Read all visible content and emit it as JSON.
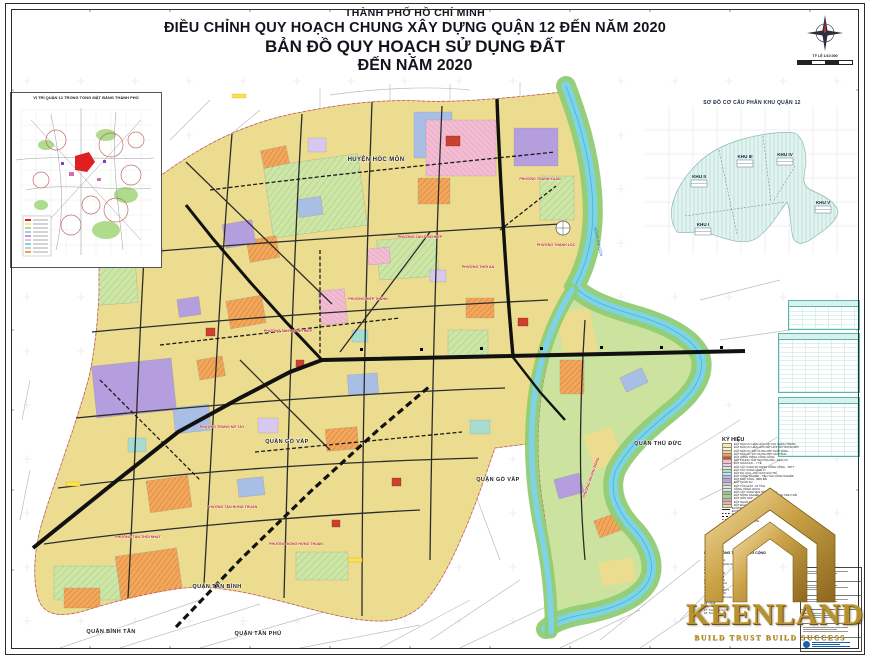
{
  "sheet": {
    "title_line1": "THÀNH PHỐ HỒ CHÍ MINH",
    "title_line2": "ĐIỀU CHỈNH QUY HOẠCH CHUNG XÂY DỰNG QUẬN 12 ĐẾN NĂM 2020",
    "title_line3": "BẢN ĐỒ QUY HOẠCH SỬ DỤNG ĐẤT",
    "title_line4": "ĐẾN NĂM 2020",
    "scale_label": "TỶ LỆ 1/10.000"
  },
  "inset_left": {
    "title": "VỊ TRÍ QUẬN 12 TRONG TỔNG MẶT BẰNG THÀNH PHỐ"
  },
  "inset_right": {
    "title": "SƠ ĐỒ CƠ CẤU PHÂN KHU QUẬN 12",
    "zones": [
      "KHU I",
      "KHU II",
      "KHU III",
      "KHU IV",
      "KHU V"
    ]
  },
  "neighbors": {
    "hoc_mon": "HUYỆN HÓC MÔN",
    "go_vap_a": "QUẬN GÒ VẤP",
    "go_vap_b": "QUẬN GÒ VẤP",
    "thu_duc": "QUẬN THỦ ĐỨC",
    "tan_binh": "QUẬN TÂN BÌNH",
    "binh_tan": "QUẬN BÌNH TÂN",
    "tan_phu": "QUẬN TÂN PHÚ"
  },
  "river_label": "SÔNG SÀI GÒN",
  "wards": [
    "PHƯỜNG THẠNH XUÂN",
    "PHƯỜNG THẠNH LỘC",
    "PHƯỜNG AN PHÚ ĐÔNG",
    "PHƯỜNG THỚI AN",
    "PHƯỜNG TÂN THỚI HIỆP",
    "PHƯỜNG HIỆP THÀNH",
    "PHƯỜNG TÂN CHÁNH HIỆP",
    "PHƯỜNG TRUNG MỸ TÂY",
    "PHƯỜNG TÂN THỚI NHẤT",
    "PHƯỜNG ĐÔNG HƯNG THUẬN",
    "PHƯỜNG TÂN HƯNG THUẬN"
  ],
  "legend": {
    "title": "KÝ HIỆU",
    "items": [
      {
        "type": "fill",
        "color": "#F6E89C",
        "label": "ĐẤT DÂN CƯ HIỆN HỮU CẢI TẠO CHỈNH TRANG"
      },
      {
        "type": "fill",
        "color": "#FBF3CE",
        "label": "ĐẤT DÂN CƯ HIỆN HỮU KẾT HỢP XÂY DỰNG MỚI"
      },
      {
        "type": "fill",
        "color": "#F4CE92",
        "label": "ĐẤT DÂN CƯ XÂY DỰNG MỚI THẤP TẦNG"
      },
      {
        "type": "fill",
        "color": "#EFA050",
        "label": "ĐẤT DÂN CƯ XÂY DỰNG MỚI CAO TẦNG"
      },
      {
        "type": "fill",
        "color": "#D84B2E",
        "label": "ĐẤT CÔNG TRÌNH CÔNG CỘNG"
      },
      {
        "type": "fill",
        "color": "#F3BBD2",
        "label": "ĐẤT TRUNG TÂM THƯƠNG MẠI - DỊCH VỤ"
      },
      {
        "type": "fill",
        "color": "#E2D0F2",
        "label": "ĐẤT GIÁO DỤC - Y TẾ"
      },
      {
        "type": "fill",
        "color": "#D9EDBB",
        "label": "ĐẤT CÂY XANH SỬ DỤNG CÔNG CỘNG - TDTT"
      },
      {
        "type": "fill",
        "color": "#ACDFCD",
        "label": "ĐẤT CÂY XANH CÁCH LY"
      },
      {
        "type": "fill",
        "color": "#BDE9F2",
        "label": "ĐẤT DU LỊCH - VUI CHƠI GIẢI TRÍ"
      },
      {
        "type": "fill",
        "color": "#AFC3E9",
        "label": "ĐẤT CÔNG NGHIỆP - TIỂU THỦ CÔNG NGHIỆP"
      },
      {
        "type": "fill",
        "color": "#B6A1E2",
        "label": "ĐẤT KHO TÀNG - BẾN BÃI"
      },
      {
        "type": "fill",
        "color": "#CCCCCC",
        "label": "ĐẤT QUÂN SỰ"
      },
      {
        "type": "fill",
        "color": "#EFE5C6",
        "label": "ĐẤT TÔN GIÁO - DI TÍCH"
      },
      {
        "type": "fill",
        "color": "#C9E9F8",
        "label": "SÔNG, KÊNH, RẠCH"
      },
      {
        "type": "fill",
        "color": "#90CC74",
        "label": "ĐẤT CÂY XANH VEN SÔNG RẠCH"
      },
      {
        "type": "fill",
        "color": "#9BD49B",
        "label": "ĐẤT NÔNG NGHIỆP KẾT HỢP DU LỊCH SINH THÁI"
      },
      {
        "type": "fill",
        "color": "#E9A0B4",
        "label": "ĐẤT HỖN HỢP"
      },
      {
        "type": "fill",
        "color": "#D8C29C",
        "label": "ĐẤT NGHĨA TRANG - NGHĨA ĐỊA"
      },
      {
        "type": "fill",
        "color": "#F0D8A0",
        "label": "ĐẤT ĐẦU MỐI HẠ TẦNG KỸ THUẬT"
      },
      {
        "type": "line",
        "color": "#222222",
        "label": "ĐƯỜNG GIAO THÔNG CHÍNH ĐÔ THỊ"
      },
      {
        "type": "dash",
        "color": "#222222",
        "label": "ĐƯỜNG DỰ PHÓNG"
      },
      {
        "type": "rail",
        "color": "#111111",
        "label": "ĐƯỜNG SẮT QUỐC GIA"
      },
      {
        "type": "dash",
        "color": "#CC3355",
        "label": "RANH GIỚI QUẬN"
      },
      {
        "type": "dash",
        "color": "#888888",
        "label": "RANH GIỚI PHƯỜNG"
      },
      {
        "type": "line",
        "color": "#555555",
        "label": "RANH KHU Ở"
      }
    ]
  },
  "legend2": {
    "title": "KÝ HIỆU CÔNG TRÌNH CÔNG CỘNG",
    "items": [
      "UBND Quận",
      "Công an Quận",
      "Ban chỉ huy Quân sự",
      "Bưu điện",
      "Bệnh viện",
      "Trung tâm y tế",
      "Trường THPT",
      "Trường THCS",
      "Trường tiểu học",
      "Nhà văn hóa",
      "Trung tâm TDTT",
      "Chợ - Siêu thị",
      "Công viên văn hóa",
      "Nhà thờ",
      "Chùa",
      "Đình - Miếu",
      "Trạm cấp nước",
      "Trạm điện"
    ]
  },
  "watermark": {
    "brand": "KEENLAND",
    "tagline": "BUILD TRUST BUILD SUCCESS"
  },
  "colors": {
    "residential": "#EBDC8F",
    "river": "#7ED4E6",
    "green_band": "#90CC74",
    "gold": "#C19A3F"
  }
}
